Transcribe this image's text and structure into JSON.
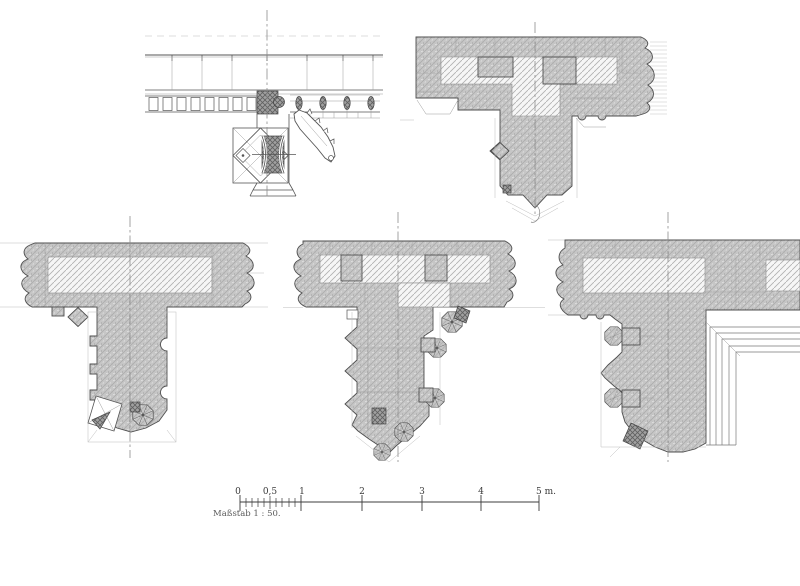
{
  "plate": {
    "scale_bar": {
      "labels": [
        "0",
        "0,5",
        "1",
        "2",
        "3",
        "4",
        "5 m."
      ],
      "caption": "Maßstab 1 : 50."
    },
    "colors": {
      "paper": "#ffffff",
      "ink": "#4f4f4f",
      "masonry_fill": "#c6c6c6",
      "light_hatch_line": "#b0b0b0",
      "dark_core_fill": "#a0a0a0",
      "faint_line": "#9b9b9b"
    }
  }
}
